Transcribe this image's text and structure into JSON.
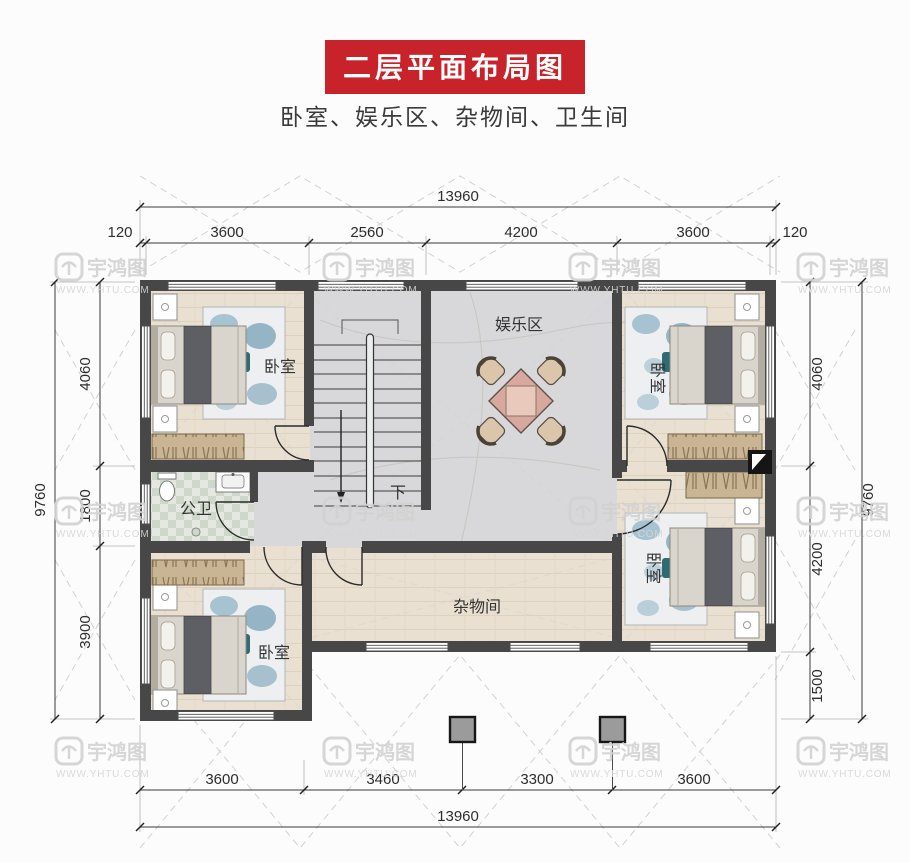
{
  "page": {
    "title": "二层平面布局图",
    "subtitle": "卧室、娱乐区、杂物间、卫生间"
  },
  "watermark": {
    "brand": "宇鸿图",
    "url": "WWW.YHTU.COM"
  },
  "dimensions": {
    "top": {
      "total": "13960",
      "segments": [
        "120",
        "3600",
        "2560",
        "4200",
        "3600",
        "120"
      ]
    },
    "bottom": {
      "total": "13960",
      "segments": [
        "3600",
        "3460",
        "3300",
        "3600"
      ]
    },
    "left": {
      "total": "9760",
      "segments": [
        "4060",
        "1800",
        "3900"
      ]
    },
    "right": {
      "total": "9760",
      "segments": [
        "4060",
        "4200",
        "1500"
      ]
    }
  },
  "rooms": {
    "bedroom": "卧室",
    "entertainment": "娱乐区",
    "bathroom": "公卫",
    "storage": "杂物间",
    "stair_down": "下"
  },
  "colors": {
    "banner_red": "#c8232b",
    "wall": "#474747",
    "wood_floor": "#e9e0d1",
    "marble_floor": "#d8d8da",
    "tile_floor": "#e4e8e0",
    "column_gray": "#9b9b9b"
  }
}
